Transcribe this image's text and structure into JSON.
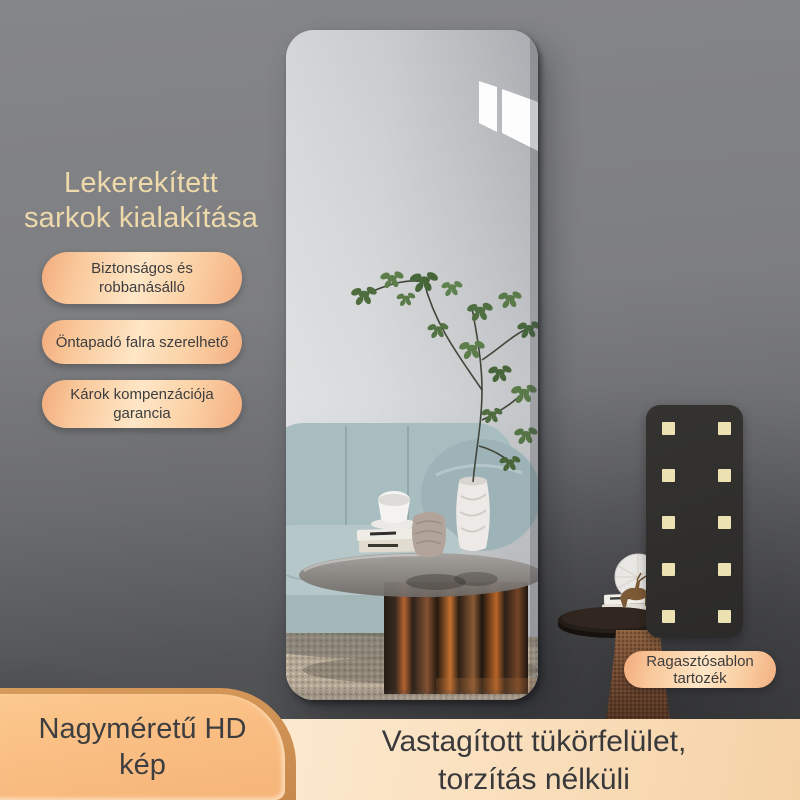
{
  "headline": {
    "text": "Lekerekített\nsarkok kialakítása",
    "color": "#eed9ab"
  },
  "feature_pills": [
    {
      "text": "Biztonságos és\nrobbanásálló"
    },
    {
      "text": "Öntapadó falra szerelhető"
    },
    {
      "text": "Károk kompenzációja\ngarancia"
    }
  ],
  "adhesive_template": {
    "rows": 5,
    "cols": 2,
    "panel_color": "#2f2e2c",
    "dot_color": "#ece1b3",
    "badge_text": "Ragasztósablon\ntartozék"
  },
  "hd_card": {
    "text": "Nagyméretű HD\nkép"
  },
  "bottom_caption": {
    "text": "Vastagított tükörfelület,\ntorzítás nélküli"
  },
  "palette": {
    "background_top": "#858689",
    "background_bottom": "#454648",
    "pill_gradient_light": "#fee6c6",
    "pill_gradient_dark": "#f3ab7c",
    "pill_text": "#3d3d3f",
    "caption_band": "#f9ddb9",
    "hd_card_fill": "#f9bd82",
    "mirror_glass": "#c4c7c9"
  }
}
